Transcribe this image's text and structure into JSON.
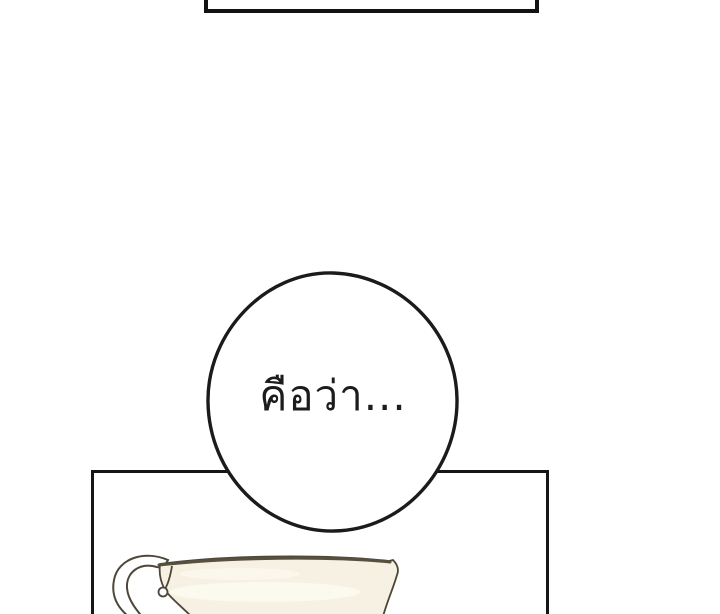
{
  "bubble": {
    "text": "คือว่า..."
  },
  "colors": {
    "background": "#ffffff",
    "panel_border": "#161616",
    "bubble_fill": "#ffffff",
    "bubble_stroke": "#1b1b1b",
    "teacup_body": "#f7f1e3",
    "teacup_outline": "#4d4738",
    "teacup_rim": "#57503e",
    "teacup_highlight": "#fffdf5"
  }
}
